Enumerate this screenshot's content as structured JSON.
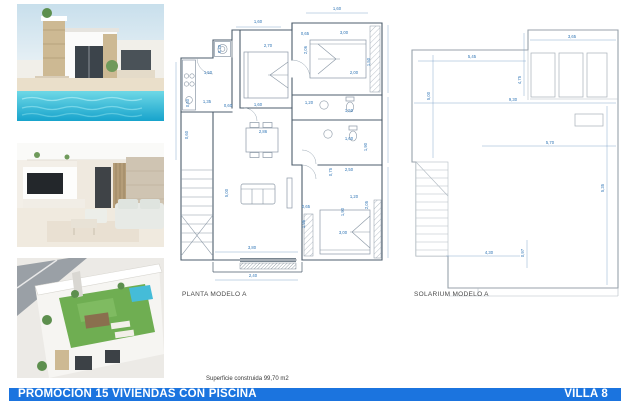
{
  "banner": {
    "title": "PROMOCIÓN 15 VIVIENDAS CON PISCINA",
    "unit": "VILLA 8"
  },
  "footnote": "Superficie construida 99,70 m2",
  "photos": [
    {
      "label": "villa-exterior-pool-photo"
    },
    {
      "label": "living-room-interior-photo"
    },
    {
      "label": "rooftop-solarium-3d-photo"
    }
  ],
  "plans": {
    "planta": {
      "title": "PLANTA MODELO A",
      "dims": [
        {
          "t": "1,60",
          "x": 258,
          "y": 23
        },
        {
          "t": "1,60",
          "x": 337,
          "y": 10
        },
        {
          "t": "0,70",
          "x": 221,
          "y": 49,
          "r": -90
        },
        {
          "t": "2,70",
          "x": 268,
          "y": 47
        },
        {
          "t": "1,50",
          "x": 208,
          "y": 74
        },
        {
          "t": "0,65",
          "x": 305,
          "y": 35
        },
        {
          "t": "3,00",
          "x": 344,
          "y": 34
        },
        {
          "t": "2,06",
          "x": 307,
          "y": 50,
          "r": -90
        },
        {
          "t": "1,50",
          "x": 370,
          "y": 62,
          "r": -90
        },
        {
          "t": "2,00",
          "x": 354,
          "y": 74
        },
        {
          "t": "1,20",
          "x": 309,
          "y": 104
        },
        {
          "t": "1,50",
          "x": 349,
          "y": 112
        },
        {
          "t": "0,60",
          "x": 189,
          "y": 103,
          "r": -90
        },
        {
          "t": "1,35",
          "x": 207,
          "y": 103
        },
        {
          "t": "0,60",
          "x": 228,
          "y": 107
        },
        {
          "t": "1,60",
          "x": 258,
          "y": 106
        },
        {
          "t": "0,60",
          "x": 188,
          "y": 135,
          "r": -90
        },
        {
          "t": "2,86",
          "x": 263,
          "y": 133
        },
        {
          "t": "5,00",
          "x": 228,
          "y": 193,
          "r": -90
        },
        {
          "t": "1,60",
          "x": 349,
          "y": 140
        },
        {
          "t": "1,90",
          "x": 367,
          "y": 147,
          "r": -90
        },
        {
          "t": "0,75",
          "x": 332,
          "y": 172,
          "r": -90
        },
        {
          "t": "2,50",
          "x": 349,
          "y": 171
        },
        {
          "t": "1,20",
          "x": 354,
          "y": 198
        },
        {
          "t": "2,05",
          "x": 368,
          "y": 205,
          "r": -90
        },
        {
          "t": "1,90",
          "x": 344,
          "y": 212,
          "r": -90
        },
        {
          "t": "0,65",
          "x": 306,
          "y": 208
        },
        {
          "t": "1,95",
          "x": 305,
          "y": 224,
          "r": -90
        },
        {
          "t": "3,00",
          "x": 343,
          "y": 234
        },
        {
          "t": "3,80",
          "x": 252,
          "y": 249
        },
        {
          "t": "2,40",
          "x": 253,
          "y": 277
        }
      ]
    },
    "solarium": {
      "title": "SOLARIUM MODELO A",
      "dims": [
        {
          "t": "3,65",
          "x": 572,
          "y": 38
        },
        {
          "t": "5,45",
          "x": 472,
          "y": 58
        },
        {
          "t": "4,75",
          "x": 521,
          "y": 80,
          "r": -90
        },
        {
          "t": "5,00",
          "x": 430,
          "y": 96,
          "r": -90
        },
        {
          "t": "9,30",
          "x": 513,
          "y": 101
        },
        {
          "t": "5,70",
          "x": 550,
          "y": 144
        },
        {
          "t": "5,35",
          "x": 604,
          "y": 188,
          "r": -90
        },
        {
          "t": "4,30",
          "x": 489,
          "y": 254
        },
        {
          "t": "0,97",
          "x": 524,
          "y": 253,
          "r": -90
        }
      ]
    }
  },
  "colors": {
    "banner_bg": "#1b74df",
    "dim_text": "#2e74b5",
    "plan_wall": "#4d5d6c",
    "solarium_line": "#98a2ab",
    "pool_blue": "#2cb4d4",
    "turf_green": "#6fae52"
  }
}
